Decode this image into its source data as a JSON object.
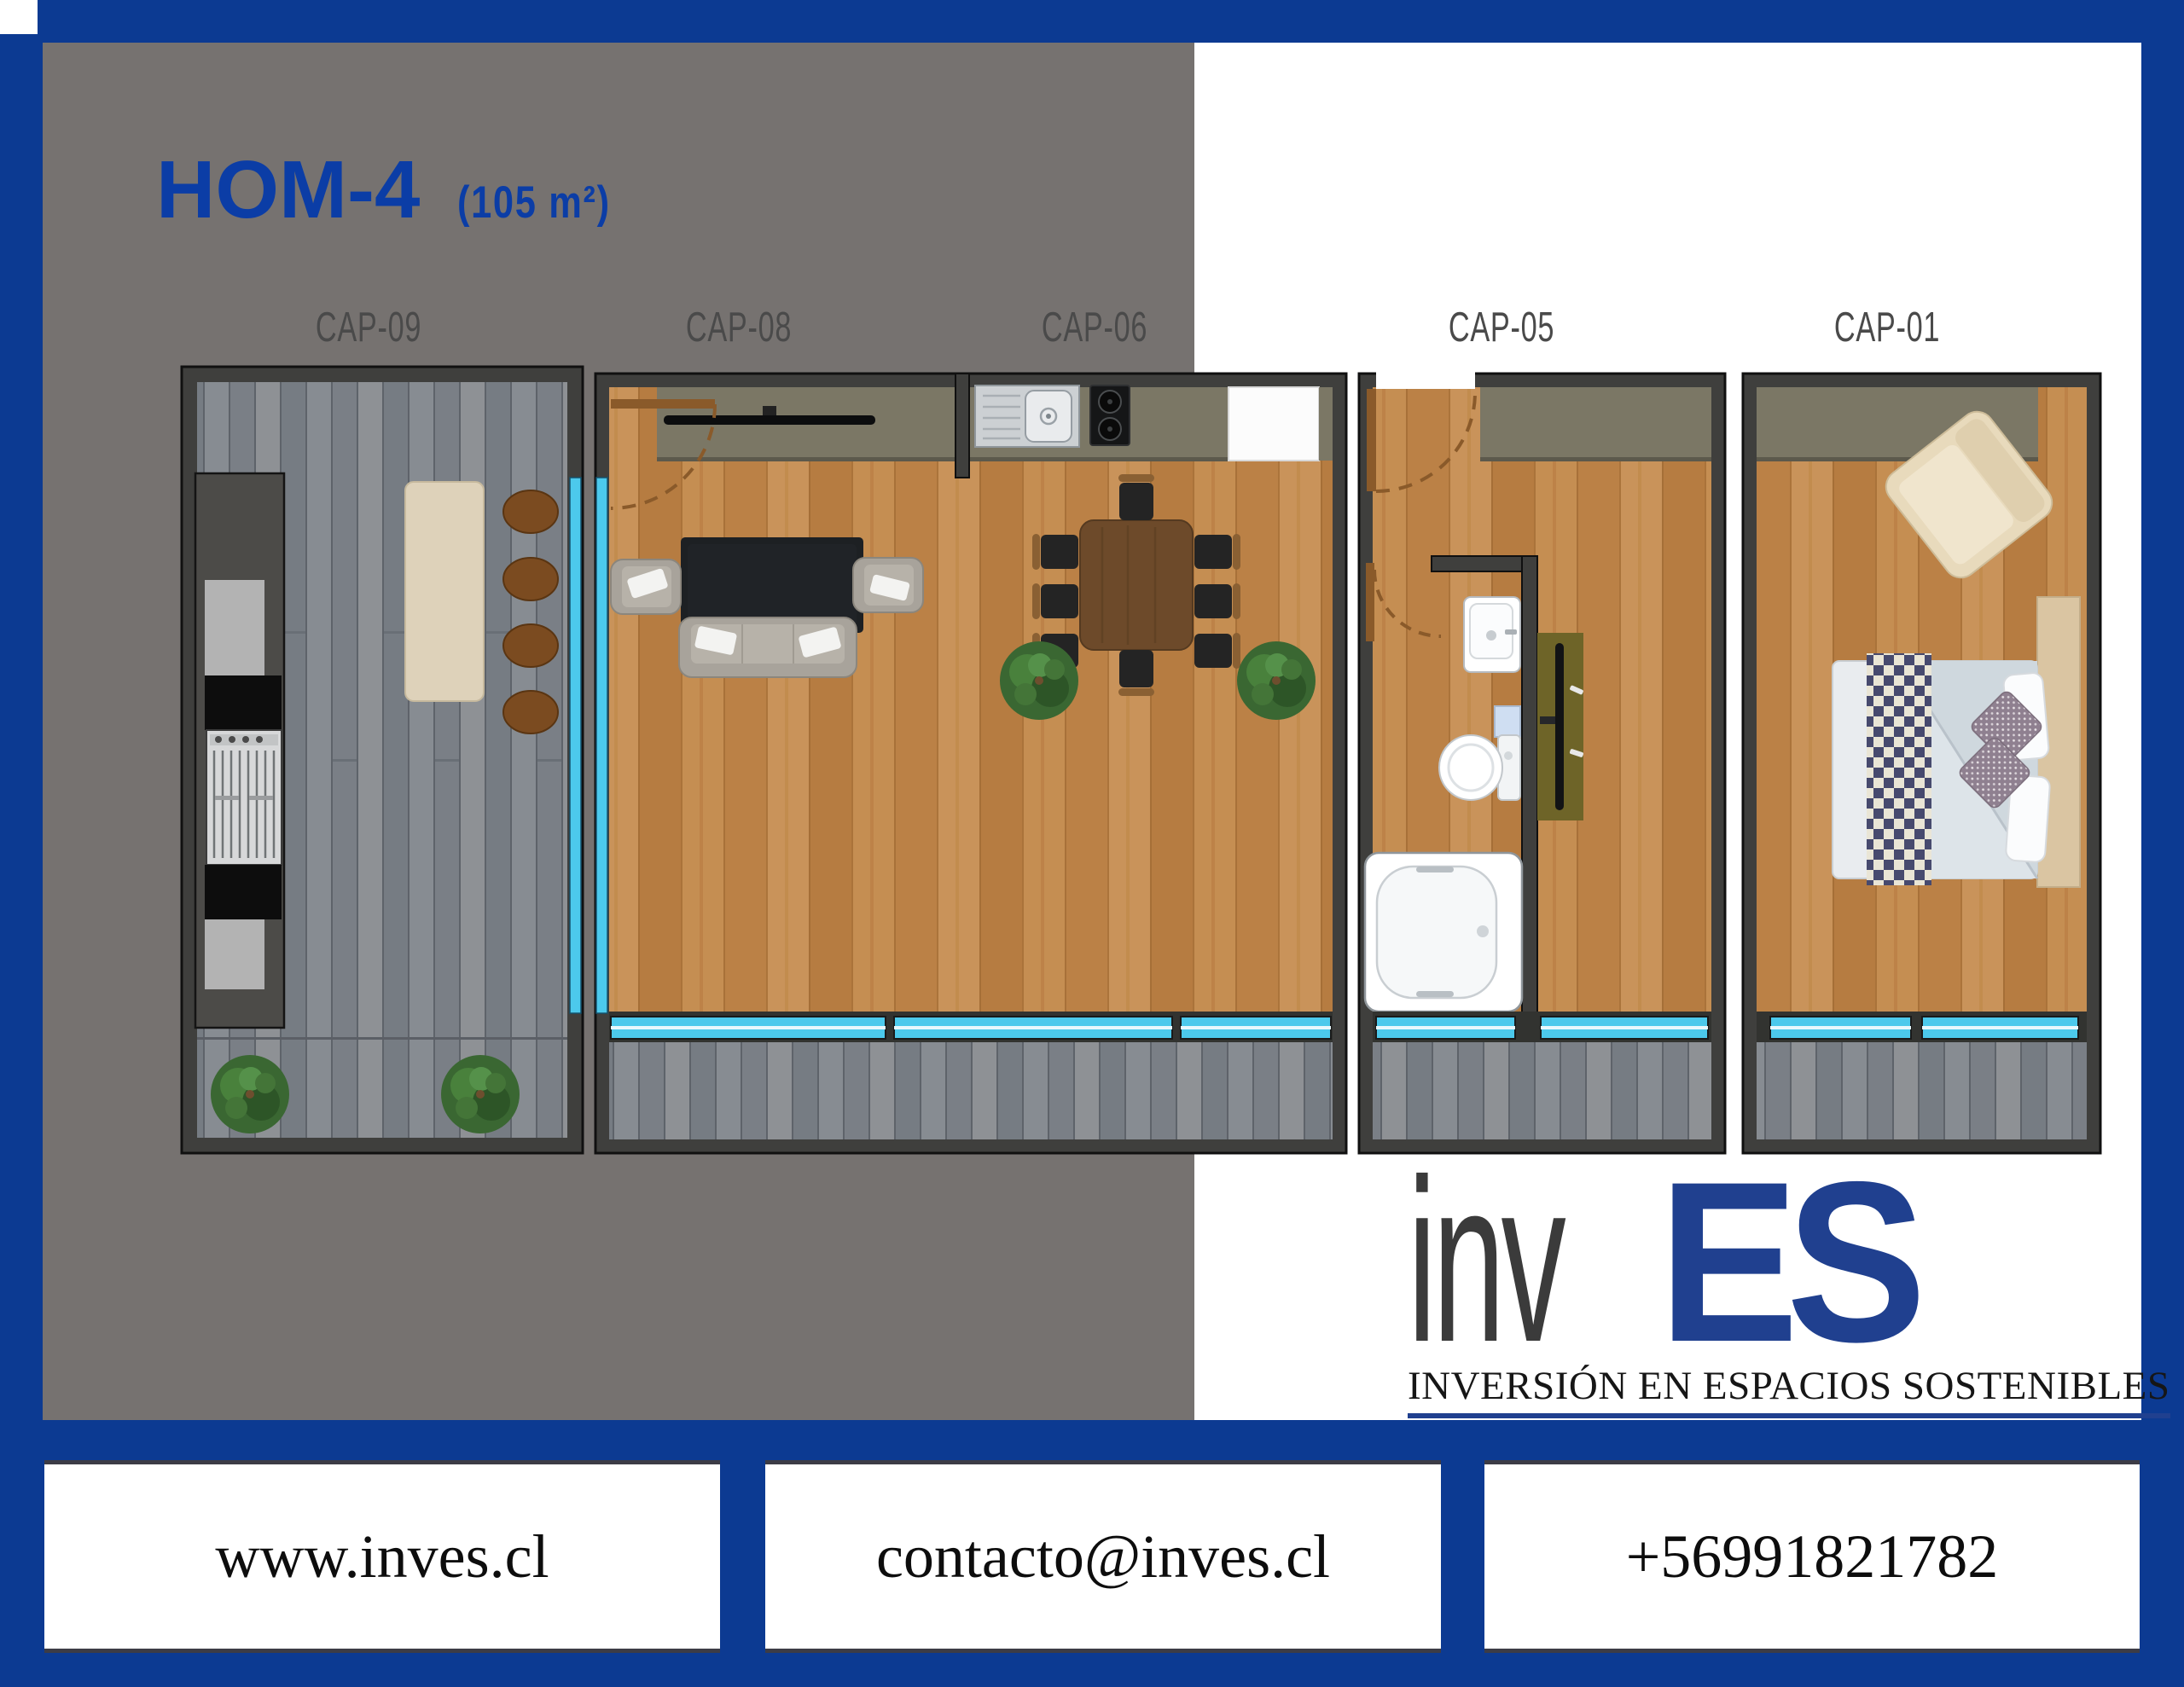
{
  "title": {
    "name": "HOM-4",
    "area": "(105 m²)"
  },
  "floorplan": {
    "modules": [
      {
        "label": "CAP-09"
      },
      {
        "label": "CAP-08"
      },
      {
        "label": "CAP-06"
      },
      {
        "label": "CAP-05"
      },
      {
        "label": "CAP-01"
      }
    ]
  },
  "logo": {
    "word_dark": "inv",
    "word_blue": "ES",
    "tagline": "INVERSIÓN EN ESPACIOS SOSTENIBLES"
  },
  "contact": {
    "website": "www.inves.cl",
    "email": "contacto@inves.cl",
    "phone": "+56991821782"
  },
  "colors": {
    "frame_blue": "#0c3a92",
    "panel_gray": "#767270",
    "title_blue": "#0b3da6",
    "logo_blue": "#20408f",
    "wall_dark": "#3f3f3d",
    "wood_floor": "#c08449",
    "deck_gray": "#82868c",
    "window_cyan": "#4cc9ec",
    "counter_olive": "#7b7765"
  }
}
